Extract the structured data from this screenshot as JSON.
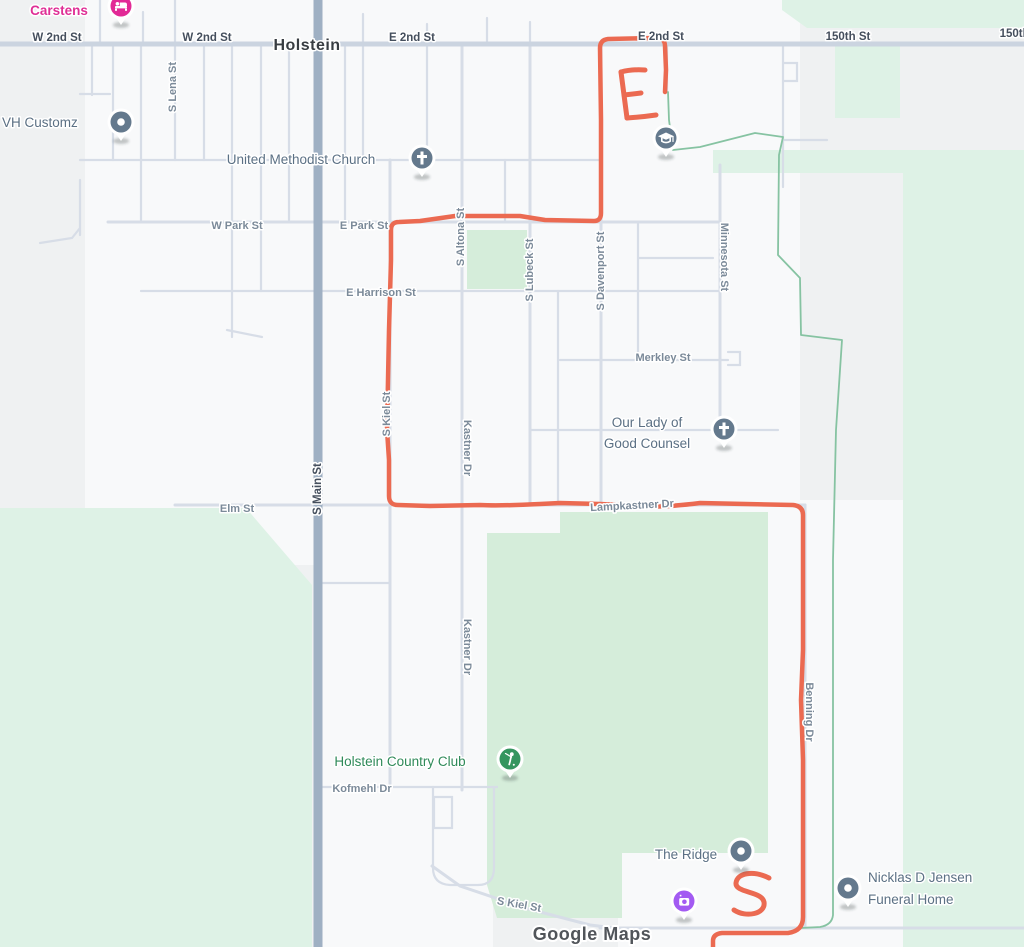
{
  "town": "Holstein",
  "watermark": "Google Maps",
  "streets": {
    "w2nd": "W 2nd St",
    "e2nd": "E 2nd St",
    "st150": "150th St",
    "s_lena": "S Lena St",
    "w_park": "W Park St",
    "e_park": "E Park St",
    "s_altona": "S Altona St",
    "s_lubeck": "S Lubeck St",
    "s_davenport": "S Davenport St",
    "minnesota": "Minnesota St",
    "e_harrison": "E Harrison St",
    "merkley": "Merkley St",
    "s_kiel": "S Kiel St",
    "kastner": "Kastner Dr",
    "s_main": "S Main St",
    "elm": "Elm St",
    "lampkastner": "Lampkastner Dr",
    "kofmehl": "Kofmehl Dr",
    "benning": "Benning Dr"
  },
  "pois": {
    "carstens": "Carstens",
    "vh_customz": "VH Customz",
    "united_methodist": "United Methodist Church",
    "our_lady_line1": "Our Lady of",
    "our_lady_line2": "Good Counsel",
    "country_club": "Holstein Country Club",
    "the_ridge": "The Ridge",
    "funeral_line1": "Nicklas D Jensen",
    "funeral_line2": "Funeral Home"
  },
  "route": {
    "letters": [
      "E",
      "S"
    ],
    "color": "#eb6a51"
  },
  "colors": {
    "land": "#eff1f2",
    "urban": "#f8f9fa",
    "greenGolf": "#d5edda",
    "greenRural": "#def2e6",
    "road": "#d7dde7",
    "roadMajor": "#cbd4e0",
    "mainRoad": "#9fb0c3",
    "route": "#eb6a51",
    "trail": "#86c3a2",
    "streetLabel": "#7b8a99",
    "streetLabelDark": "#454f5d",
    "townLabel": "#383d42",
    "poiLabel": "#5b7084",
    "poiGreen": "#2f8a59",
    "poiPink": "#df2f96",
    "pinGrey": "#64798d",
    "pinGreen": "#35955f",
    "pinPurple": "#a35bf2",
    "pinPink": "#e22a96",
    "watermark": "#51555a"
  }
}
